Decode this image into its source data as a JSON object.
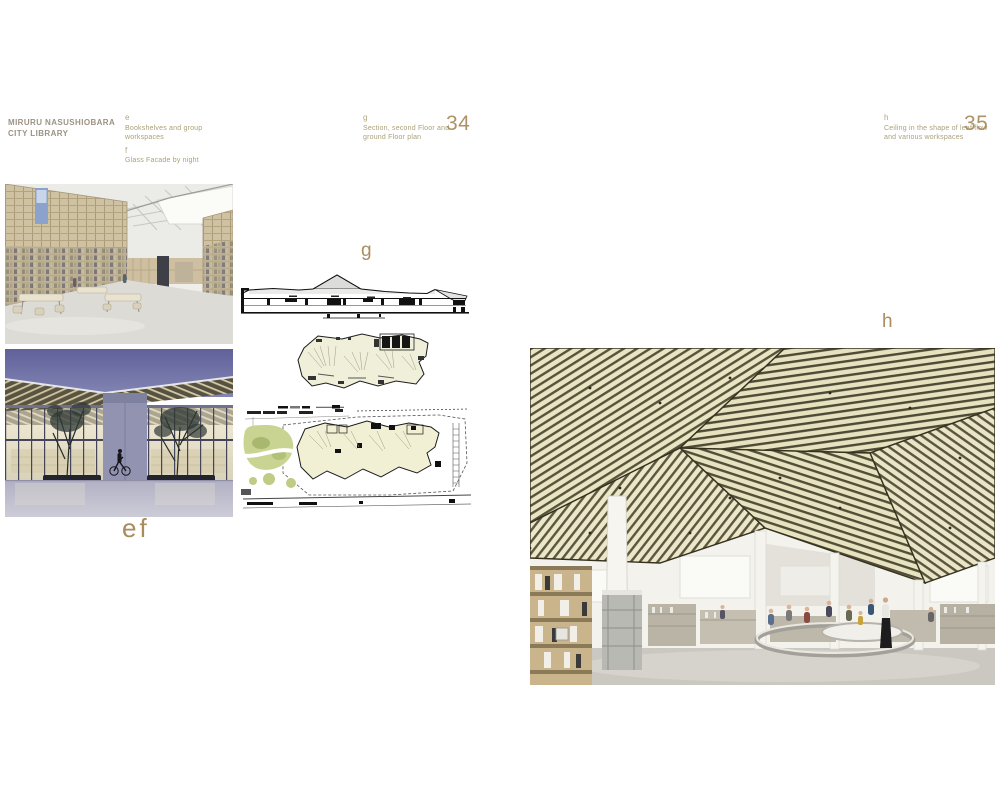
{
  "header": {
    "line1": "MIRURU NASUSHIOBARA",
    "line2": "CITY LIBRARY"
  },
  "captions": {
    "e_key": "e",
    "e_line1": "Bookshelves and group",
    "e_line2": "workspaces",
    "f_key": "f",
    "f_line1": "Glass Facade by night",
    "g_key": "g",
    "g_line1": "Section, second Floor and",
    "g_line2": "ground Floor plan",
    "h_key": "h",
    "h_line1": "Ceiling in the shape of leaf flow",
    "h_line2": "and various workspaces"
  },
  "page_numbers": {
    "left": "34",
    "right": "35"
  },
  "figure_labels": {
    "ef": "ef",
    "g": "g",
    "h": "h"
  },
  "figures": {
    "photo_e": "interior with tall bookshelf walls and skylight",
    "photo_f": "glass facade by night",
    "section_g": "building section drawing",
    "plan_second_floor": "second floor plan",
    "plan_ground_floor": "ground floor site plan",
    "photo_h": "leaf-flow slatted ceiling hall"
  },
  "colors": {
    "accent_tan": "#ad9268",
    "label_tan": "#a88c5d",
    "caption_olive": "#aba179",
    "header_taupe": "#9c9284",
    "plan_fill": "#f0f0da",
    "site_green": "#c9d493",
    "night_sky": "#6a6ba3",
    "ceiling_light": "#e9e4c2",
    "ceiling_dark": "#534e38"
  }
}
